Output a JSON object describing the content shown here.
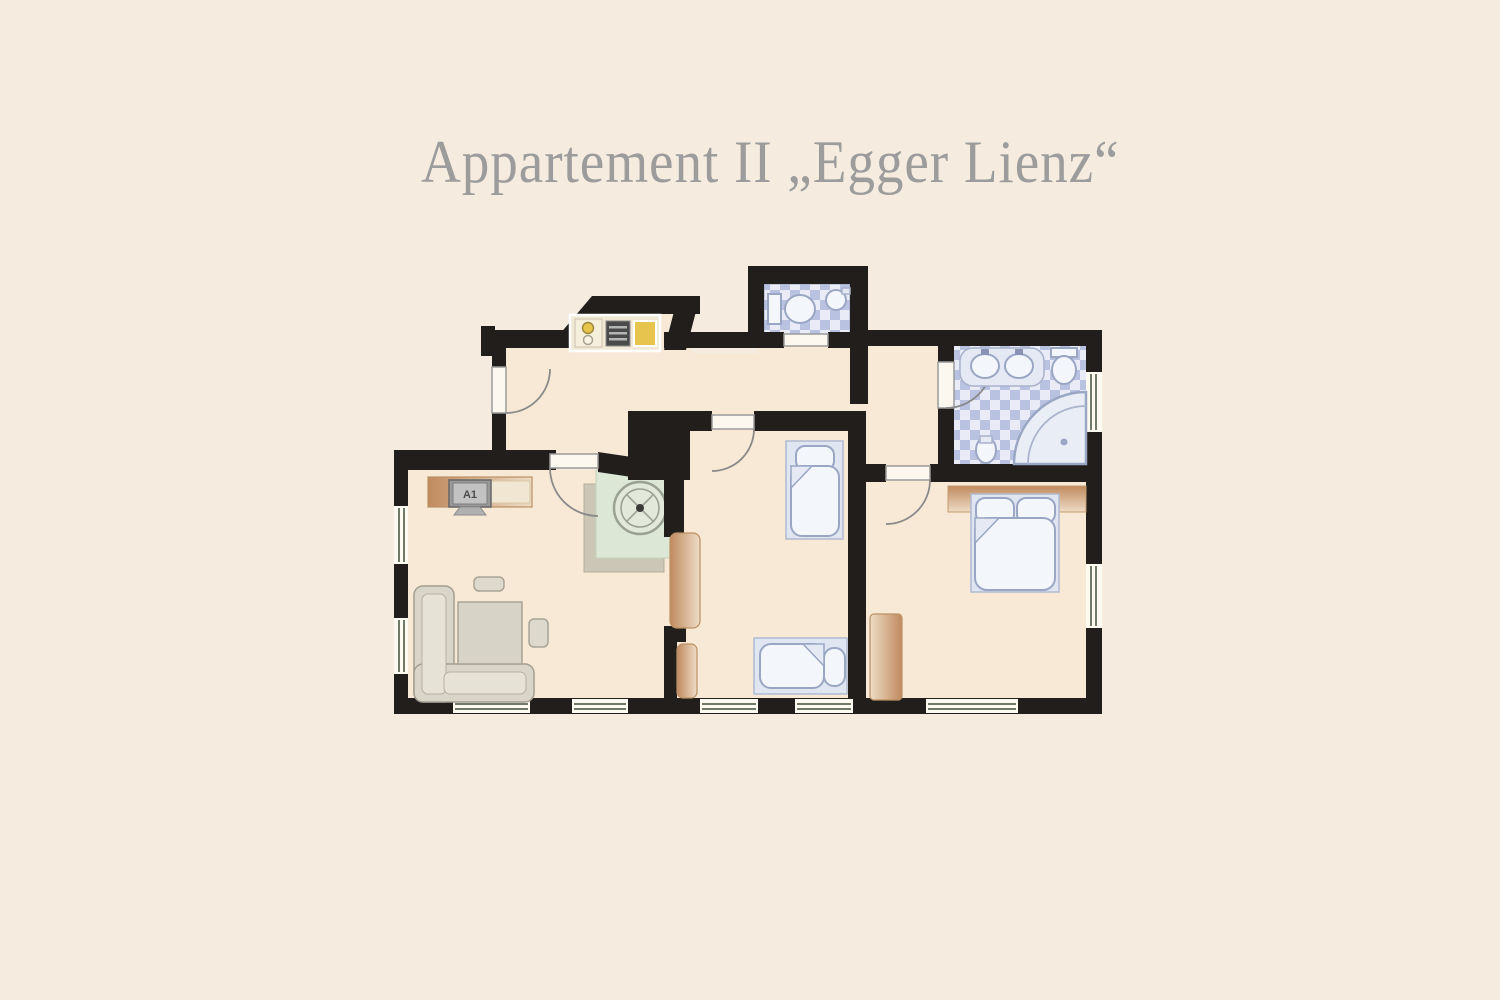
{
  "page": {
    "background": "#f5ecdf",
    "title": "Appartement II „Egger Lienz“",
    "title_color": "#9c9c9c"
  },
  "floorplan": {
    "tv_label": "A1",
    "colors": {
      "wall": "#211e1b",
      "floor": "#f8e9d7",
      "tile_dark": "#b9c2e0",
      "tile_light": "#e9ecf6",
      "fixture_outline": "#9aa7c4",
      "wood_dark": "#c08a5f",
      "wood_light": "#eedcc6",
      "appliance_yellow": "#e6c44d",
      "stove_dark": "#4a4a4a",
      "mat_green": "#dce7d5",
      "sofa_gray": "#d9d5c8"
    },
    "fixtures": [
      "entrance-door",
      "kitchenette",
      "stove",
      "sink",
      "wc-toilet",
      "wc-hand-basin",
      "bathroom-double-washbasin",
      "bathroom-toilet",
      "corner-shower",
      "bidet",
      "round-dining-table",
      "corner-sofa",
      "coffee-table",
      "tv-sideboard",
      "single-bed",
      "single-bed",
      "double-bed",
      "wardrobe",
      "wardrobe-panels"
    ]
  }
}
